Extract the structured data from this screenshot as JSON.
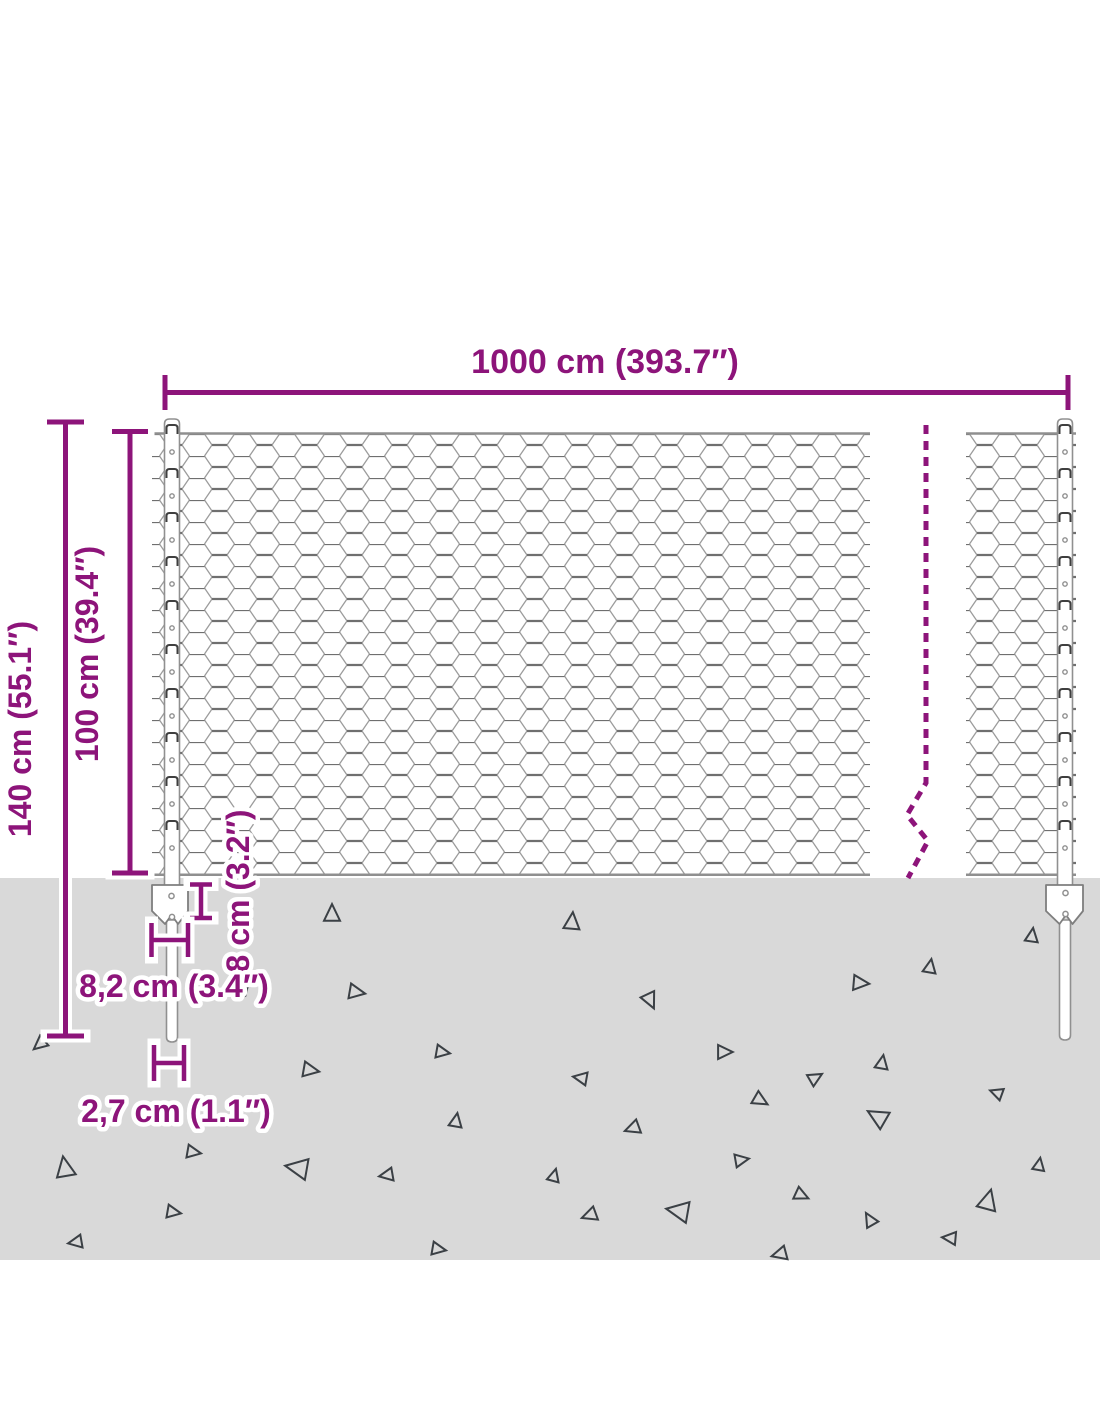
{
  "diagram": {
    "labels": {
      "total_width": "1000 cm (393.7″)",
      "total_height": "140 cm (55.1″)",
      "mesh_height": "100 cm (39.4″)",
      "anchor_height": "8 cm (3.2″)",
      "anchor_width": "8,2 cm (3.4″)",
      "post_width": "2,7 cm (1.1″)"
    },
    "colors": {
      "dimension_purple": "#8D147A",
      "halo_white": "#FFFFFF",
      "ground_gray": "#D9D9D9",
      "mesh_wire": "#9C9C9C",
      "mesh_twist": "#6F6F6F",
      "rail_gray": "#8F8F8F",
      "post_stroke": "#909090",
      "clip_dark": "#3F3F3F",
      "triangle_dark": "#3B4045"
    },
    "ground_triangles": [
      [
        332,
        914,
        16,
        0
      ],
      [
        572,
        922,
        16,
        5
      ],
      [
        356,
        992,
        15,
        100
      ],
      [
        650,
        1000,
        15,
        155
      ],
      [
        930,
        967,
        13,
        10
      ],
      [
        860,
        983,
        15,
        95
      ],
      [
        1032,
        936,
        13,
        8
      ],
      [
        40,
        1044,
        13,
        230
      ],
      [
        244,
        987,
        13,
        40
      ],
      [
        310,
        1070,
        15,
        100
      ],
      [
        442,
        1052,
        13,
        100
      ],
      [
        456,
        1121,
        13,
        10
      ],
      [
        65,
        1168,
        19,
        350
      ],
      [
        193,
        1152,
        13,
        100
      ],
      [
        298,
        1168,
        21,
        280
      ],
      [
        387,
        1175,
        13,
        260
      ],
      [
        173,
        1212,
        13,
        100
      ],
      [
        76,
        1242,
        13,
        260
      ],
      [
        438,
        1249,
        13,
        100
      ],
      [
        724,
        1052,
        14,
        90
      ],
      [
        581,
        1078,
        13,
        280
      ],
      [
        815,
        1078,
        13,
        60
      ],
      [
        882,
        1063,
        13,
        10
      ],
      [
        760,
        1100,
        14,
        120
      ],
      [
        997,
        1093,
        12,
        290
      ],
      [
        878,
        1117,
        19,
        300
      ],
      [
        633,
        1128,
        14,
        250
      ],
      [
        741,
        1160,
        13,
        80
      ],
      [
        554,
        1176,
        12,
        15
      ],
      [
        801,
        1195,
        13,
        115
      ],
      [
        1039,
        1165,
        12,
        10
      ],
      [
        590,
        1215,
        14,
        250
      ],
      [
        679,
        1211,
        21,
        280
      ],
      [
        870,
        1220,
        13,
        330
      ],
      [
        988,
        1201,
        19,
        15
      ],
      [
        950,
        1238,
        13,
        275
      ],
      [
        780,
        1254,
        14,
        255
      ]
    ]
  }
}
